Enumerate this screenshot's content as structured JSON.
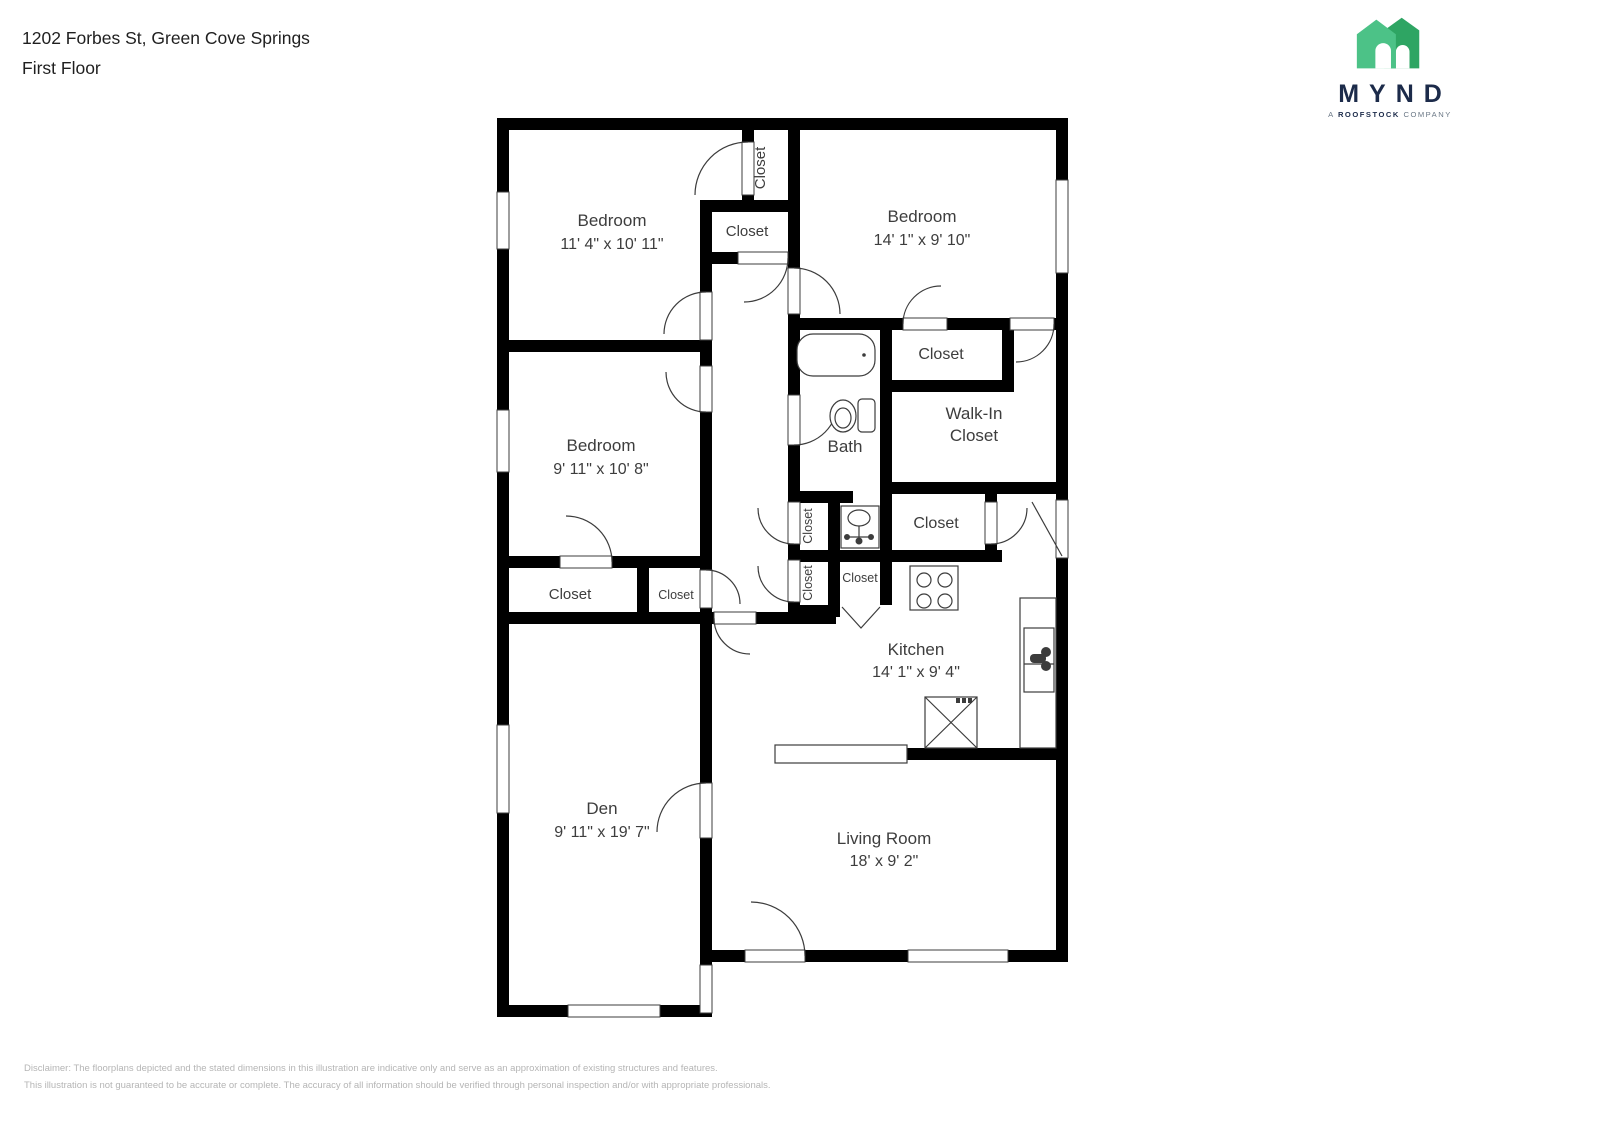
{
  "header": {
    "address": "1202 Forbes St, Green Cove Springs",
    "floor": "First Floor"
  },
  "logo": {
    "brand": "MYND",
    "tagline_prefix": "A",
    "tagline_bold": "ROOFSTOCK",
    "tagline_suffix": "COMPANY",
    "house_color_light": "#4CC287",
    "house_color_dark": "#2EA563",
    "wordmark_color": "#1C2B4A"
  },
  "plan": {
    "rooms": {
      "bedroom_top_left": {
        "name": "Bedroom",
        "dims": "11' 4\" x 10' 11\""
      },
      "bedroom_top_right": {
        "name": "Bedroom",
        "dims": "14' 1\" x 9' 10\""
      },
      "bedroom_middle": {
        "name": "Bedroom",
        "dims": "9' 11\" x 10' 8\""
      },
      "bath": {
        "name": "Bath"
      },
      "walk_in_closet": {
        "line1": "Walk-In",
        "line2": "Closet"
      },
      "kitchen": {
        "name": "Kitchen",
        "dims": "14' 1\" x 9' 4\""
      },
      "den": {
        "name": "Den",
        "dims": "9' 11\" x 19' 7\""
      },
      "living_room": {
        "name": "Living Room",
        "dims": "18' x 9' 2\""
      }
    },
    "closets": [
      "Closet",
      "Closet",
      "Closet",
      "Closet",
      "Closet",
      "Closet",
      "Closet",
      "Closet",
      "Closet"
    ]
  },
  "disclaimer": {
    "line1": "Disclaimer: The floorplans depicted and the stated dimensions in this illustration are indicative only and serve as an approximation of existing structures and features.",
    "line2": "This illustration is not guaranteed to be accurate or complete. The accuracy of all information should be verified through personal inspection and/or with appropriate professionals."
  }
}
